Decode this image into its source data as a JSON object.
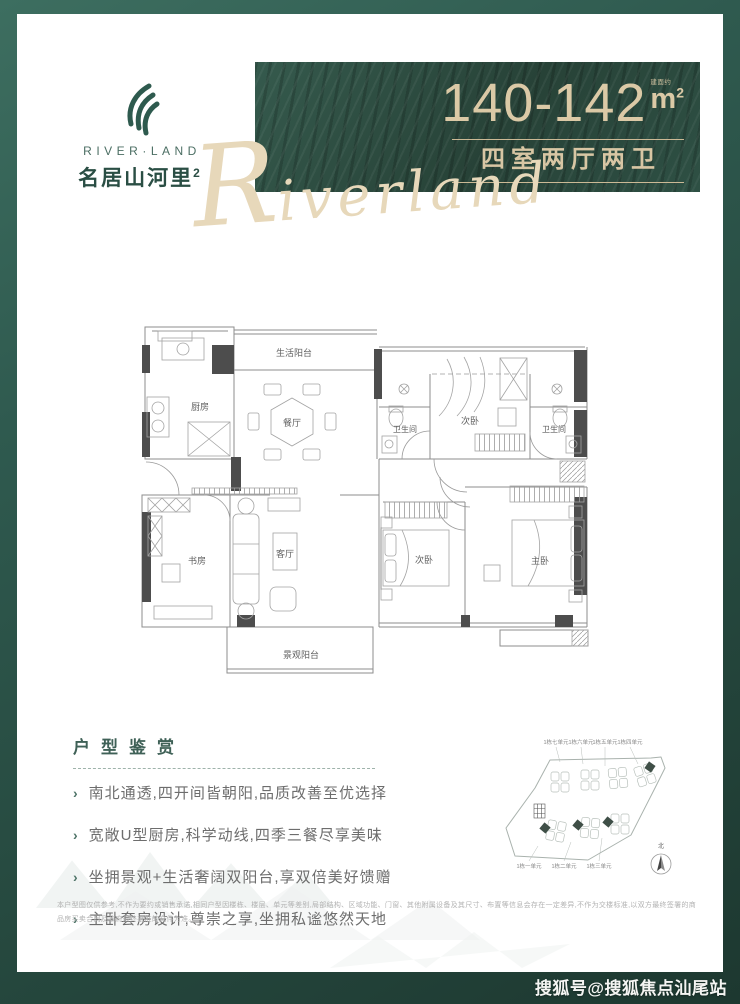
{
  "poster": {
    "watermark": "搜狐号@搜狐焦点汕尾站"
  },
  "logo": {
    "brand_en": "RIVER·LAND",
    "brand_cn": "名居山河里",
    "brand_cn_sup": "2"
  },
  "banner": {
    "area_range": "140-142",
    "area_prefix": "建面约",
    "area_unit": "m",
    "area_unit_sup": "2",
    "layout_type": "四室两厅两卫",
    "script_initial": "R",
    "script_rest": "iverland"
  },
  "floorplan": {
    "rooms": {
      "kitchen": "厨房",
      "life_balcony": "生活阳台",
      "dining": "餐厅",
      "bedroom_top": "次卧",
      "bath_left": "卫生间",
      "bath_right": "卫生间",
      "study": "书房",
      "living": "客厅",
      "view_balcony": "景观阳台",
      "bedroom_bottom": "次卧",
      "master_bedroom": "主卧"
    }
  },
  "appreciation": {
    "title": "户型鉴赏",
    "bullets": [
      "南北通透,四开间皆朝阳,品质改善至优选择",
      "宽敞U型厨房,科学动线,四季三餐尽享美味",
      "坐拥景观+生活奢阔双阳台,享双倍美好馈赠",
      "主卧套房设计,尊崇之享,坐拥私谧悠然天地"
    ]
  },
  "siteplan": {
    "top_labels": [
      "1栋七单元",
      "1栋六单元",
      "1栋五单元",
      "1栋四单元"
    ],
    "bottom_labels": [
      "1栋一单元",
      "1栋二单元",
      "1栋三单元"
    ],
    "compass_label": "北"
  },
  "disclaimer": "本户型图仅供参考,不作为要约或销售承诺,相同户型因楼栋、楼层、单元等差别,局部结构、区域功能、门窗、其他附属设备及其尺寸、布置等信息会存在一定差异,不作为交楼标准,以双方最终签署的商品房买卖合同及政府最终批准的文件为准。",
  "colors": {
    "frame_green": "#2b5248",
    "banner_green": "#2c4c41",
    "champagne": "#d9c7a4",
    "logo_green": "#2e5a4e",
    "text_gray": "#6d6d6d"
  }
}
